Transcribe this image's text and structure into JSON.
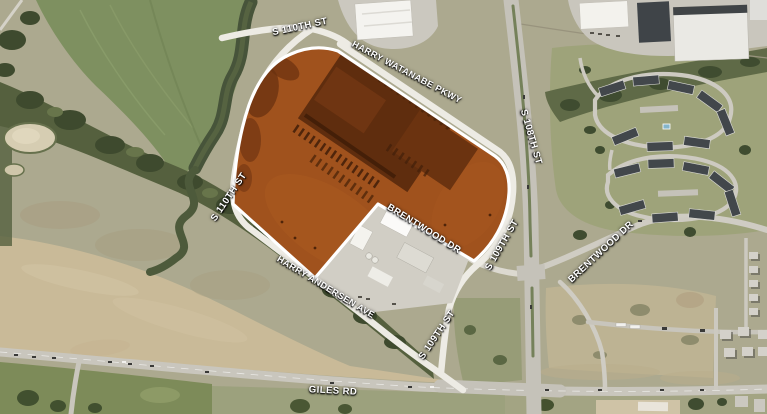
{
  "map": {
    "description": "Aerial imagery site map with highlighted development parcel",
    "parcel": {
      "name": "highlighted-parcel",
      "fill": "#A0521D",
      "border": "#FFFFFF"
    },
    "labels": [
      {
        "id": "s110th-top",
        "text": "S 110TH ST"
      },
      {
        "id": "harry-watanabe-pkwy",
        "text": "HARRY WATANABE PKWY"
      },
      {
        "id": "s110th-west",
        "text": "S 110TH ST"
      },
      {
        "id": "harry-andersen-ave",
        "text": "HARRY ANDERSEN AVE"
      },
      {
        "id": "brentwood-dr-west",
        "text": "BRENTWOOD DR"
      },
      {
        "id": "s109th-upper",
        "text": "S 109TH ST"
      },
      {
        "id": "s108th",
        "text": "S 108TH ST"
      },
      {
        "id": "brentwood-dr-east",
        "text": "BRENTWOOD DR"
      },
      {
        "id": "s109th-lower",
        "text": "S 109TH ST"
      },
      {
        "id": "giles-rd",
        "text": "GILES RD"
      }
    ]
  }
}
